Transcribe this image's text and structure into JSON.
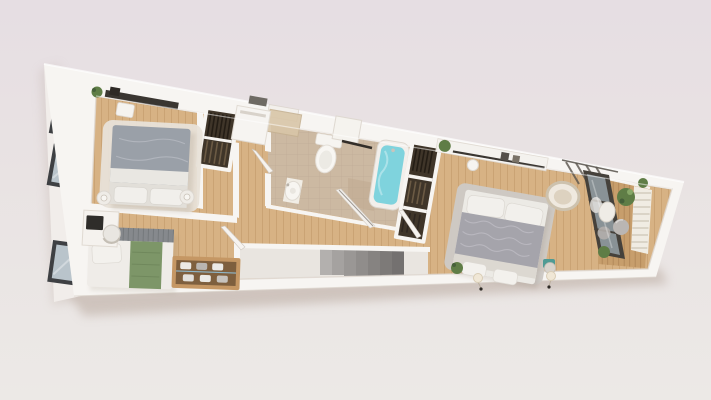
{
  "scene": {
    "kind": "3d-floorplan-render",
    "description": "Bird's-eye 3D render of a narrow wedge-shaped apartment with sloped top wall, three exterior windows on the left facade, two bedrooms on the left, central bathroom with tub, stairwell opening, master bedroom and a timber-deck balcony on the right"
  },
  "colors": {
    "bg_top": "#e6dee3",
    "bg_mid": "#e9e3e3",
    "bg_bottom": "#ece9e6",
    "shadow": "#b3a296",
    "wall": "#f7f5f2",
    "wall_edge": "#ddd6ce",
    "facade": "#f1edea",
    "window_frame": "#3e4043",
    "window_glass": "#b9c4cb",
    "wood_floor": "#d7b284",
    "wood_plank_line": "#b58c5c",
    "tile_floor": "#ccb9a2",
    "tile_line": "#b2a089",
    "deck_wood": "#c79e6c",
    "deck_plank_line": "#9c7346",
    "stair_void": "#e9e5e0",
    "stair_tread": "#a5a2a0",
    "rug_light": "#e8e2d8",
    "rug_gray": "#cdc9c5",
    "duvet_gray": "#9aa0a8",
    "master_duvet": "#a5a4ab",
    "bedding_white": "#efece8",
    "blanket_green": "#7d9668",
    "headboard_stripe": "#86898d",
    "wardrobe_interior": "#3f3529",
    "bathtub_water": "#7fd3dd",
    "plant_green": "#5f7d46",
    "metal_frame": "#45413b",
    "glass_partition": "#8f999e",
    "louver": "#f0ece3",
    "bench_wood": "#c59764"
  },
  "floor_plan": {
    "windows_left_count": 3,
    "rooms": [
      {
        "name": "bedroom-1",
        "floor": "wood",
        "furniture": [
          "double-bed-gray",
          "area-rug",
          "two-nightstand-lamps",
          "wall-shelf",
          "plant",
          "pendant-lamp"
        ]
      },
      {
        "name": "bedroom-2",
        "floor": "wood",
        "furniture": [
          "bed-green-blanket",
          "desk",
          "monitor",
          "desk-chair",
          "shoe-bench"
        ]
      },
      {
        "name": "closet-hall",
        "floor": "wood",
        "furniture": [
          "open-wardrobe",
          "white-cabinet",
          "doormat",
          "vent-grille"
        ]
      },
      {
        "name": "bathroom",
        "floor": "tile",
        "furniture": [
          "toilet",
          "wall-cabinet",
          "towel-rail",
          "washbasin",
          "bathtub",
          "shower-area"
        ]
      },
      {
        "name": "walk-in-wardrobe",
        "floor": "wood",
        "furniture": [
          "open-wardrobe-tall"
        ]
      },
      {
        "name": "master-bedroom",
        "floor": "wood",
        "furniture": [
          "double-bed",
          "gray-rug",
          "wall-shelf",
          "clothes-rail",
          "pendant-lamp",
          "hanging-egg-chair",
          "bedside-plant",
          "side-table",
          "two-wall-sconces"
        ]
      },
      {
        "name": "stairwell",
        "floor": "void",
        "furniture": [
          "stair-treads",
          "handrail"
        ]
      },
      {
        "name": "balcony",
        "floor": "deck",
        "furniture": [
          "glass-partition",
          "louver-screen",
          "pergola-beams",
          "planters",
          "sphere-lantern",
          "shell-chair"
        ]
      }
    ],
    "doors": [
      "entrance-door",
      "bathroom-door",
      "bedroom-2-door",
      "master-bedroom-door"
    ]
  }
}
